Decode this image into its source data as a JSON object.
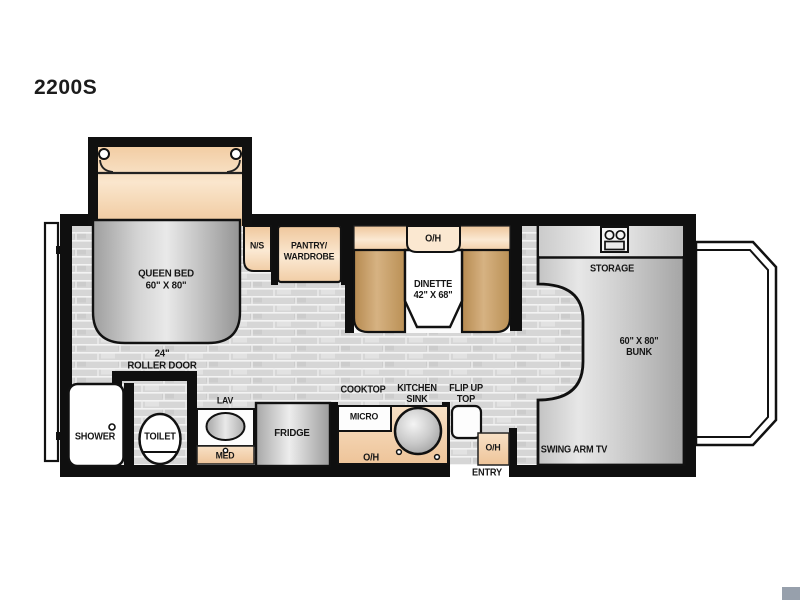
{
  "model": "2200S",
  "labels": {
    "queen_bed": "QUEEN BED\n60\" X 80\"",
    "roller_door": "24\"\nROLLER DOOR",
    "nightstand": "N/S",
    "pantry_wardrobe": "PANTRY/\nWARDROBE",
    "dinette_overhead": "O/H",
    "dinette": "DINETTE\n42\" X 68\"",
    "storage": "STORAGE",
    "bunk": "60\" X 80\"\nBUNK",
    "shower": "SHOWER",
    "toilet": "TOILET",
    "lav": "LAV",
    "med": "MED",
    "fridge": "FRIDGE",
    "micro": "MICRO",
    "cooktop": "COOKTOP",
    "kitchen_sink": "KITCHEN\nSINK",
    "flip_up_top": "FLIP UP\nTOP",
    "kitchen_overhead": "O/H",
    "entry_overhead": "O/H",
    "entry": "ENTRY",
    "swing_arm_tv": "SWING ARM TV"
  },
  "icons": {
    "storage_appliance": "two-burner-appliance-icon"
  },
  "colors": {
    "wall": "#0f0f0f",
    "floor": "#d7d7d7",
    "cabinet_tan": "#f2cfa8",
    "bench_brown": "#c49a62",
    "furniture_gray": "#c6c6c6"
  }
}
